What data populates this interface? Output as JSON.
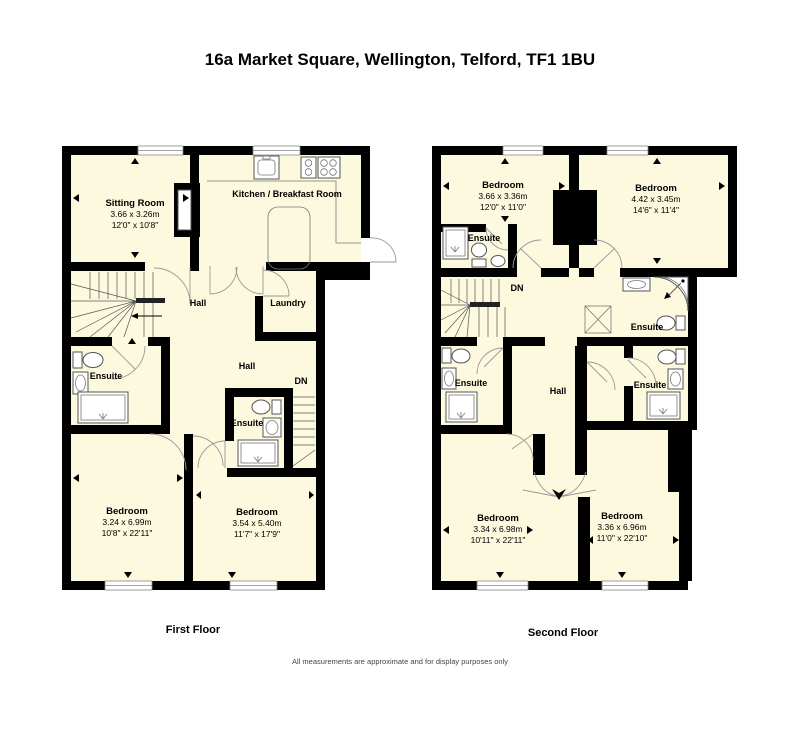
{
  "title": "16a Market Square, Wellington, Telford, TF1 1BU",
  "disclaimer": "All measurements are approximate and for display purposes only",
  "colors": {
    "floor_fill": "#FCF9DE",
    "wall": "#000000",
    "arc": "#999999",
    "window_line": "#888888"
  },
  "floors": [
    {
      "label": "First Floor",
      "rooms": {
        "sitting": {
          "name": "Sitting Room",
          "metric": "3.66 x 3.26m",
          "imperial": "12'0\" x 10'8\""
        },
        "kitchen": {
          "name": "Kitchen / Breakfast Room"
        },
        "hall_upper": {
          "name": "Hall"
        },
        "laundry": {
          "name": "Laundry"
        },
        "hall_lower": {
          "name": "Hall"
        },
        "stairs_down": {
          "name": "DN"
        },
        "ensuite_left": {
          "name": "Ensuite"
        },
        "ensuite_middle": {
          "name": "Ensuite"
        },
        "bedroom_left": {
          "name": "Bedroom",
          "metric": "3.24 x 6.99m",
          "imperial": "10'8\" x 22'11\""
        },
        "bedroom_right": {
          "name": "Bedroom",
          "metric": "3.54 x 5.40m",
          "imperial": "11'7\" x 17'9\""
        }
      }
    },
    {
      "label": "Second Floor",
      "rooms": {
        "bedroom_top_left": {
          "name": "Bedroom",
          "metric": "3.66 x 3.36m",
          "imperial": "12'0\" x 11'0\""
        },
        "bedroom_top_right": {
          "name": "Bedroom",
          "metric": "4.42 x 3.45m",
          "imperial": "14'6\" x 11'4\""
        },
        "ensuite_top_left": {
          "name": "Ensuite"
        },
        "stairs_down": {
          "name": "DN"
        },
        "ensuite_top_right": {
          "name": "Ensuite"
        },
        "ensuite_mid_left": {
          "name": "Ensuite"
        },
        "ensuite_mid_right": {
          "name": "Ensuite"
        },
        "hall": {
          "name": "Hall"
        },
        "bedroom_bottom_left": {
          "name": "Bedroom",
          "metric": "3.34 x 6.98m",
          "imperial": "10'11\" x 22'11\""
        },
        "bedroom_bottom_right": {
          "name": "Bedroom",
          "metric": "3.36 x 6.96m",
          "imperial": "11'0\" x 22'10\""
        }
      }
    }
  ]
}
